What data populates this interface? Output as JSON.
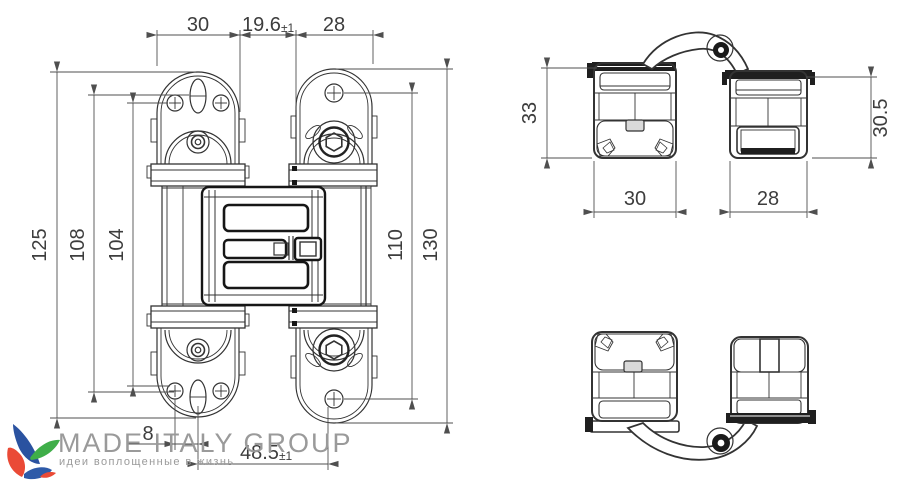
{
  "front_view": {
    "dim_top_left": "30",
    "dim_top_gap": "19.6",
    "dim_top_gap_tol": "±1",
    "dim_top_right": "28",
    "dim_left_outer": "125",
    "dim_left_mid": "108",
    "dim_left_inner": "104",
    "dim_right_inner": "110",
    "dim_right_outer": "130",
    "dim_bottom_offset": "8",
    "dim_bottom_span": "48.5",
    "dim_bottom_span_tol": "±1"
  },
  "top_view": {
    "dim_left_height": "33",
    "dim_right_height": "30.5",
    "dim_left_width": "30",
    "dim_right_width": "28"
  },
  "logo": {
    "title": "MADE ITALY GROUP",
    "tagline": "идеи воплощенные в жизнь"
  },
  "colors": {
    "part_line": "#333333",
    "dim_line": "#4f4f4f",
    "heavy_line": "#161616",
    "logo_text": "#9a9a9a",
    "logo_blue": "#2a52a0",
    "logo_green": "#3fae49",
    "logo_red": "#ea4a36"
  }
}
